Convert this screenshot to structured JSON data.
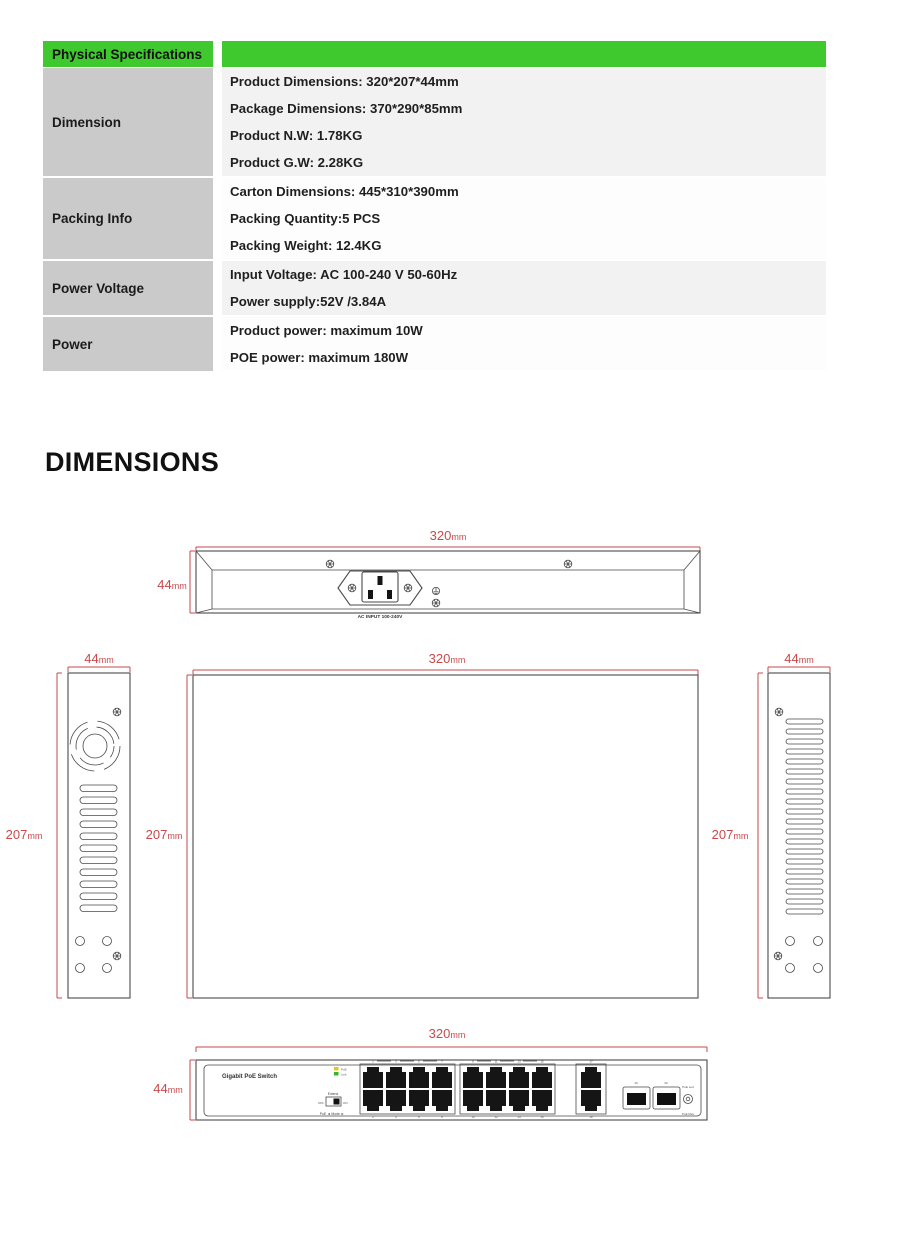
{
  "colors": {
    "accent_green": "#3fc92e",
    "dim_red": "#c9494b",
    "line_gray": "#4a4a4a"
  },
  "spec_table": {
    "header": "Physical Specifications",
    "rows": [
      {
        "label": "Dimension",
        "lines": [
          "Product Dimensions: 320*207*44mm",
          "Package Dimensions: 370*290*85mm",
          "Product N.W: 1.78KG",
          "Product G.W: 2.28KG"
        ]
      },
      {
        "label": "Packing Info",
        "lines": [
          "Carton Dimensions: 445*310*390mm",
          "Packing Quantity:5 PCS",
          "Packing Weight: 12.4KG"
        ]
      },
      {
        "label": "Power Voltage",
        "lines": [
          "Input Voltage: AC 100-240 V 50-60Hz",
          "Power supply:52V /3.84A"
        ]
      },
      {
        "label": "Power",
        "lines": [
          "Product power: maximum 10W",
          "POE power: maximum 180W"
        ]
      }
    ]
  },
  "section_title": "DIMENSIONS",
  "drawings": {
    "rear": {
      "w": "320",
      "wu": "mm",
      "h": "44",
      "hu": "mm",
      "ac_label": "AC INPUT 100-240V"
    },
    "side_left": {
      "w": "44",
      "wu": "mm",
      "h": "207",
      "hu": "mm"
    },
    "top": {
      "w": "320",
      "wu": "mm",
      "h_left": "207",
      "h_left_u": "mm",
      "h_right": "207",
      "h_right_u": "mm"
    },
    "side_right": {
      "w": "44",
      "wu": "mm",
      "h": "207",
      "hu": "mm"
    },
    "front": {
      "w": "320",
      "wu": "mm",
      "h": "44",
      "hu": "mm",
      "panel_title": "Gigabit PoE Switch",
      "led_poe": "PoE",
      "led_link": "Link",
      "extend_label": "Extend",
      "off": "OFF",
      "on": "ON",
      "mode_label": "PoE ◄ Mode ►",
      "port_top": [
        "1",
        "3",
        "5",
        "7",
        "9",
        "11",
        "13",
        "15"
      ],
      "port_bottom": [
        "2",
        "4",
        "6",
        "8",
        "10",
        "12",
        "14",
        "16"
      ],
      "uplink_top": "17",
      "uplink_bottom": "18",
      "sfp": [
        "19",
        "20"
      ],
      "reset_top": "PoE Led",
      "reset_bottom": "PoE Max"
    }
  }
}
